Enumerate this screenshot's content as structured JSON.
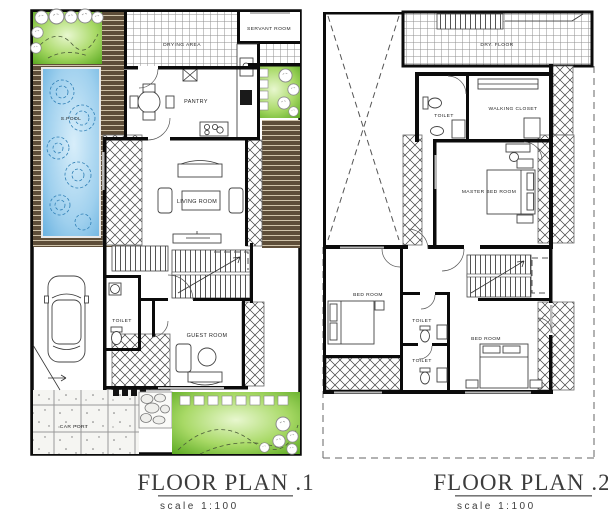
{
  "plans": {
    "plan1": {
      "title": "FLOOR PLAN .1",
      "scale_label": "scale  1:100",
      "labels": {
        "pool": "S.POOL",
        "drying_area": "DRYING AREA",
        "servant_room": "SERVANT ROOM",
        "pantry": "PANTRY",
        "living_room": "LIVING ROOM",
        "toilet": "TOILET",
        "guest_room": "GUEST ROOM",
        "car_port": "CAR PORT"
      }
    },
    "plan2": {
      "title": "FLOOR PLAN .2",
      "scale_label": "scale  1:100",
      "labels": {
        "dry_floor": "DRY. FLOOR",
        "toilet_top": "TOILET",
        "walking_closet": "WALKING CLOSET",
        "master_bed_room": "MASTER BED ROOM",
        "bed_room_left": "BED ROOM",
        "toilet_mid": "TOILET",
        "toilet_bottom": "TOILET",
        "bed_room_right": "BED ROOM"
      }
    }
  },
  "colors": {
    "wall": "#0b0b0b",
    "paper": "#ffffff",
    "garden_green_edge": "#58a81f",
    "garden_green_light": "#e8f7cf",
    "pool_blue_edge": "#62aede",
    "pool_blue_light": "#d8eefa",
    "deck_brown": "#5e4e39",
    "deck_plank_line": "#cfc3a9",
    "tile_line": "#8f8f8f",
    "hatch_line": "#3f3f3f",
    "title_text": "#3c3c3c"
  }
}
